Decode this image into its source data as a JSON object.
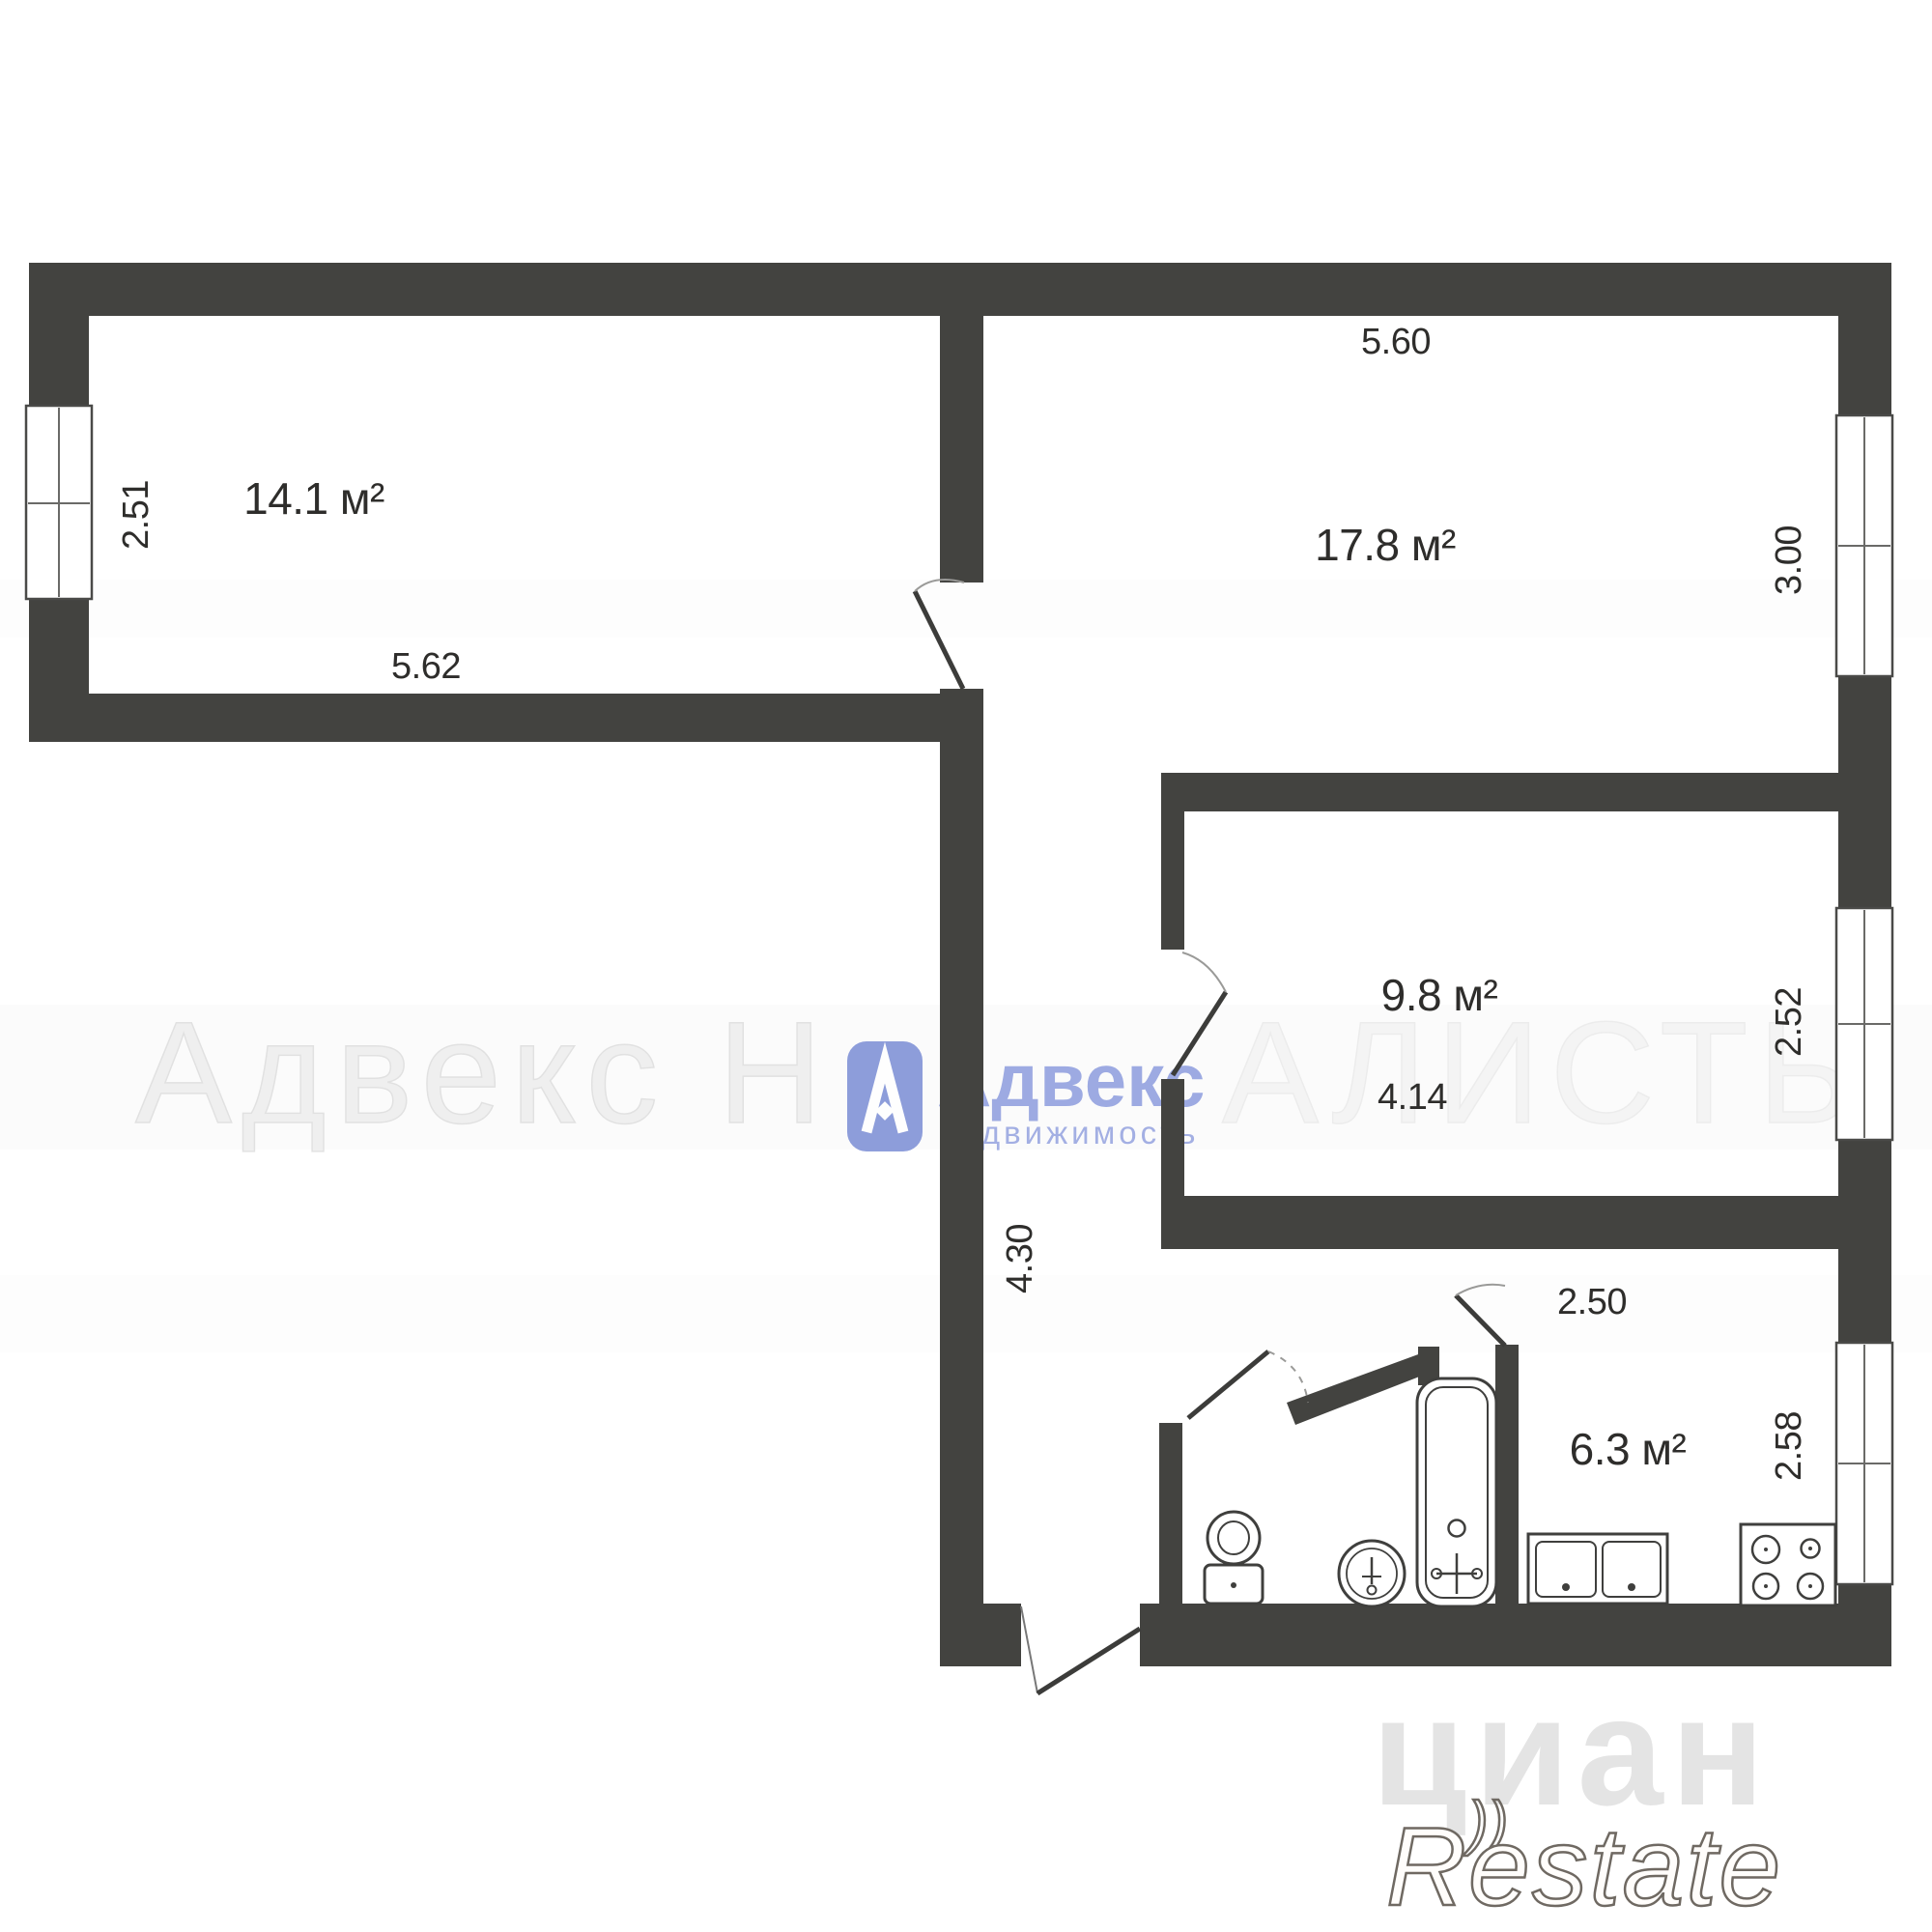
{
  "rooms": [
    {
      "id": "room-14-1",
      "area": "14.1 м²",
      "width": "5.62",
      "side": "2.51"
    },
    {
      "id": "room-17-8",
      "area": "17.8 м²",
      "top": "5.60",
      "side": "3.00"
    },
    {
      "id": "room-9-8",
      "area": "9.8 м²",
      "width": "4.14",
      "side": "2.52"
    },
    {
      "id": "kitchen",
      "area": "6.3 м²",
      "width": "2.50",
      "side": "2.58"
    }
  ],
  "corridor": {
    "length": "4.30"
  },
  "watermarks": {
    "agency_big_left": "Адвекс Н",
    "agency_big_right": "АЛИСТЫ",
    "agency_name": "Адвекс",
    "agency_sub": "недвижимость",
    "portal": "циан",
    "brand": "Restate",
    "brand_mark": "))"
  },
  "colors": {
    "wall": "#434340",
    "label_text": "#2e2d2b",
    "accent_blue": "#7286d3",
    "watermark_gray": "#cfcfcf"
  }
}
